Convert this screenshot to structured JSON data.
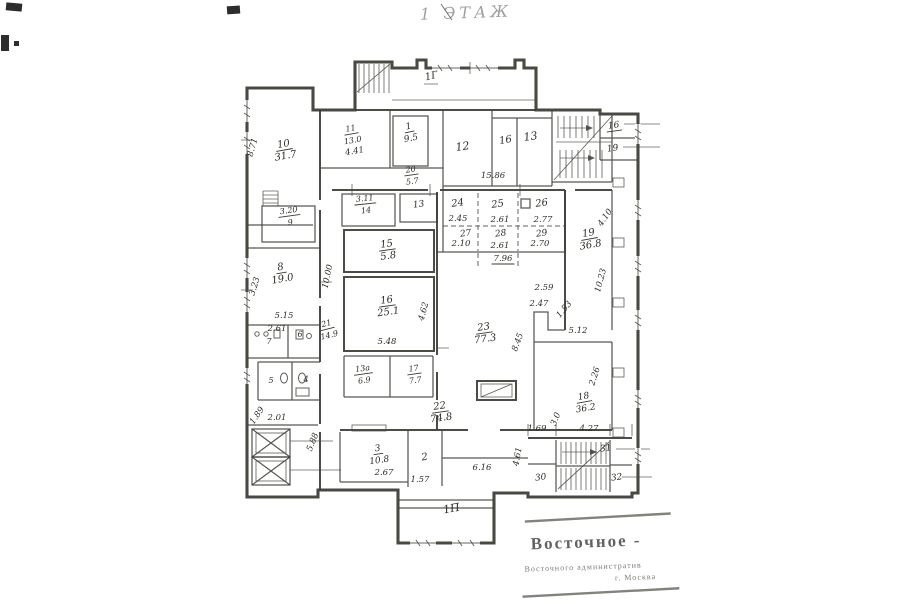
{
  "title": "1 ЭТАЖ",
  "stamp": {
    "line1": "Восточное -",
    "line2": "Восточного административ",
    "line3": "г. Москва"
  },
  "plan": {
    "room_labels": [
      {
        "n": "10",
        "a": "31.7",
        "x": 284,
        "y": 147,
        "r": -10
      },
      {
        "n": "3.20",
        "a": "9",
        "x": 289,
        "y": 213,
        "r": -8,
        "s": 8
      },
      {
        "n": "11",
        "a": "13.0",
        "x": 351,
        "y": 131,
        "r": -10,
        "s": 8,
        "extra": "4.41"
      },
      {
        "n": "1",
        "a": "9.5",
        "x": 409,
        "y": 129,
        "r": -12,
        "s": 9
      },
      {
        "n": "20",
        "a": "5.7",
        "x": 411,
        "y": 172,
        "r": -8,
        "s": 8
      },
      {
        "n": "3.11",
        "a": "14",
        "x": 365,
        "y": 201,
        "r": -6,
        "s": 8
      },
      {
        "n": "19",
        "a": "36.8",
        "x": 589,
        "y": 236,
        "r": -10
      },
      {
        "n": "15",
        "a": "5.8",
        "x": 387,
        "y": 247,
        "r": -8
      },
      {
        "n": "16",
        "a": "25.1",
        "x": 387,
        "y": 303,
        "r": -8
      },
      {
        "n": "8",
        "a": "19.0",
        "x": 281,
        "y": 270,
        "r": -10
      },
      {
        "n": "21",
        "a": "14.9",
        "x": 327,
        "y": 326,
        "r": -14,
        "s": 8
      },
      {
        "n": "23",
        "a": "77.3",
        "x": 484,
        "y": 330,
        "r": -8
      },
      {
        "n": "13а",
        "a": "6.9",
        "x": 363,
        "y": 371,
        "r": -8,
        "s": 8
      },
      {
        "n": "17",
        "a": "7.7",
        "x": 414,
        "y": 371,
        "r": -8,
        "s": 8
      },
      {
        "n": "18",
        "a": "36.2",
        "x": 584,
        "y": 399,
        "r": -10,
        "s": 9
      },
      {
        "n": "22",
        "a": "74.8",
        "x": 440,
        "y": 409,
        "r": -8
      },
      {
        "n": "3",
        "a": "10.8",
        "x": 378,
        "y": 451,
        "r": -8,
        "s": 9
      }
    ],
    "texts": [
      {
        "t": "12",
        "x": 463,
        "y": 150,
        "s": 11,
        "r": -8
      },
      {
        "t": "16",
        "x": 506,
        "y": 143,
        "s": 10,
        "r": -10
      },
      {
        "t": "13",
        "x": 531,
        "y": 140,
        "s": 11,
        "r": -8
      },
      {
        "t": "16",
        "x": 614,
        "y": 128,
        "s": 9,
        "r": -8,
        "u": true
      },
      {
        "t": "19",
        "x": 613,
        "y": 151,
        "s": 9,
        "r": -8
      },
      {
        "t": "13",
        "x": 419,
        "y": 207,
        "s": 9,
        "r": -8
      },
      {
        "t": "24",
        "x": 458,
        "y": 206,
        "s": 10,
        "r": -8
      },
      {
        "t": "25",
        "x": 498,
        "y": 207,
        "s": 10,
        "r": -8
      },
      {
        "t": "26",
        "x": 542,
        "y": 206,
        "s": 10,
        "r": -8
      },
      {
        "t": "27",
        "x": 466,
        "y": 236,
        "s": 9,
        "r": -8
      },
      {
        "t": "28",
        "x": 501,
        "y": 236,
        "s": 9,
        "r": -8
      },
      {
        "t": "29",
        "x": 542,
        "y": 236,
        "s": 9,
        "r": -8
      },
      {
        "t": "7",
        "x": 269,
        "y": 344,
        "s": 8,
        "r": 0
      },
      {
        "t": "6",
        "x": 300,
        "y": 337,
        "s": 8,
        "r": 0
      },
      {
        "t": "5",
        "x": 271,
        "y": 383,
        "s": 8,
        "r": 0
      },
      {
        "t": "4",
        "x": 306,
        "y": 382,
        "s": 8,
        "r": 0
      },
      {
        "t": "2",
        "x": 425,
        "y": 460,
        "s": 10,
        "r": -8
      },
      {
        "t": "30",
        "x": 541,
        "y": 480,
        "s": 9,
        "r": -8
      },
      {
        "t": "31",
        "x": 606,
        "y": 451,
        "s": 9,
        "r": -8
      },
      {
        "t": "32",
        "x": 617,
        "y": 480,
        "s": 9,
        "r": -8
      },
      {
        "t": "1Г",
        "x": 432,
        "y": 79,
        "s": 10,
        "r": -12
      },
      {
        "t": "1П",
        "x": 452,
        "y": 512,
        "s": 11,
        "r": -10
      }
    ],
    "dims": [
      {
        "t": "8.71",
        "x": 255,
        "y": 148,
        "r": -74
      },
      {
        "t": "15.86",
        "x": 493,
        "y": 178
      },
      {
        "t": "2.45",
        "x": 458,
        "y": 221
      },
      {
        "t": "2.61",
        "x": 500,
        "y": 222
      },
      {
        "t": "2.77",
        "x": 543,
        "y": 222
      },
      {
        "t": "2.10",
        "x": 461,
        "y": 246
      },
      {
        "t": "2.61",
        "x": 500,
        "y": 248
      },
      {
        "t": "2.70",
        "x": 540,
        "y": 246
      },
      {
        "t": "7.96",
        "x": 503,
        "y": 261,
        "u": true
      },
      {
        "t": "4.10",
        "x": 607,
        "y": 219,
        "r": -55
      },
      {
        "t": "10.23",
        "x": 603,
        "y": 281,
        "r": -75
      },
      {
        "t": "2.59",
        "x": 544,
        "y": 290
      },
      {
        "t": "2.47",
        "x": 539,
        "y": 306
      },
      {
        "t": "1.53",
        "x": 566,
        "y": 311,
        "r": -50
      },
      {
        "t": "5.12",
        "x": 578,
        "y": 333
      },
      {
        "t": "2.26",
        "x": 597,
        "y": 377,
        "r": -72
      },
      {
        "t": "8.45",
        "x": 520,
        "y": 343,
        "r": -70
      },
      {
        "t": "4.62",
        "x": 426,
        "y": 312,
        "r": -75
      },
      {
        "t": "5.48",
        "x": 387,
        "y": 344
      },
      {
        "t": "10.00",
        "x": 330,
        "y": 277,
        "r": -78
      },
      {
        "t": "3.23",
        "x": 257,
        "y": 287,
        "r": -73
      },
      {
        "t": "5.15",
        "x": 284,
        "y": 318
      },
      {
        "t": "2.61",
        "x": 277,
        "y": 331
      },
      {
        "t": "1.89",
        "x": 259,
        "y": 417,
        "r": -55
      },
      {
        "t": "2.01",
        "x": 277,
        "y": 420
      },
      {
        "t": "5.88",
        "x": 315,
        "y": 443,
        "r": -68
      },
      {
        "t": "2.67",
        "x": 384,
        "y": 475
      },
      {
        "t": "1.57",
        "x": 420,
        "y": 482
      },
      {
        "t": "6.16",
        "x": 482,
        "y": 470
      },
      {
        "t": "1.69",
        "x": 537,
        "y": 431
      },
      {
        "t": "4.27",
        "x": 589,
        "y": 431
      },
      {
        "t": "3.0",
        "x": 558,
        "y": 420,
        "r": -68
      },
      {
        "t": "4.61",
        "x": 520,
        "y": 457,
        "r": -80
      }
    ]
  }
}
